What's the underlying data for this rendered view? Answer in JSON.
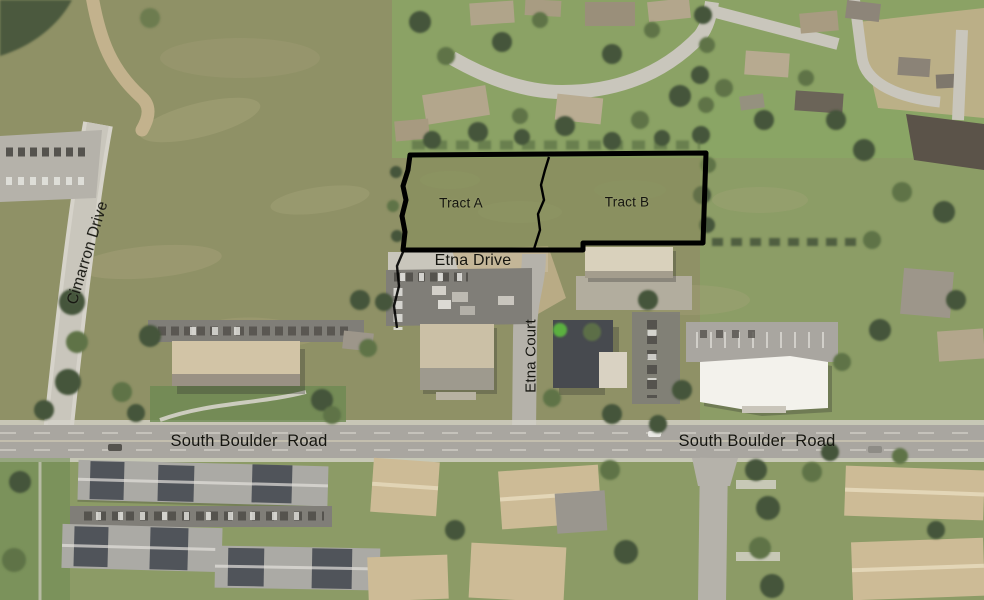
{
  "labels": {
    "tract_a": "Tract A",
    "tract_b": "Tract B",
    "etna_drive": "Etna Drive",
    "etna_court": "Etna Court",
    "cimarron_drive": "Cimarron Drive",
    "south_boulder_road_left": "South Boulder  Road",
    "south_boulder_road_right": "South Boulder  Road"
  },
  "colors": {
    "field": "#8f9166",
    "field_light": "#b0a982",
    "tract_fill": "#849059",
    "lawn": "#8aa866",
    "lawn_dark": "#6d8a52",
    "road": "#c9c6bc",
    "road_mid": "#b5b2aa",
    "road_main": "#a9a6a0",
    "sidewalk": "#d6d3ca",
    "dirt": "#c3b28d",
    "gravel": "#b2ad9e",
    "asphalt": "#807e78",
    "car_dark": "#55534e",
    "car_white": "#e9e8e4",
    "tree": "#44543a",
    "tree_light": "#5e7347",
    "roof_tan": "#cdbb96",
    "roof_tan2": "#b3a68c",
    "roof_white": "#f3f2ec",
    "roof_dark": "#474a4f",
    "roof_gray": "#abaaa5",
    "roof_charcoal": "#50545a",
    "boundary": "#000000",
    "label": "#15150f"
  }
}
